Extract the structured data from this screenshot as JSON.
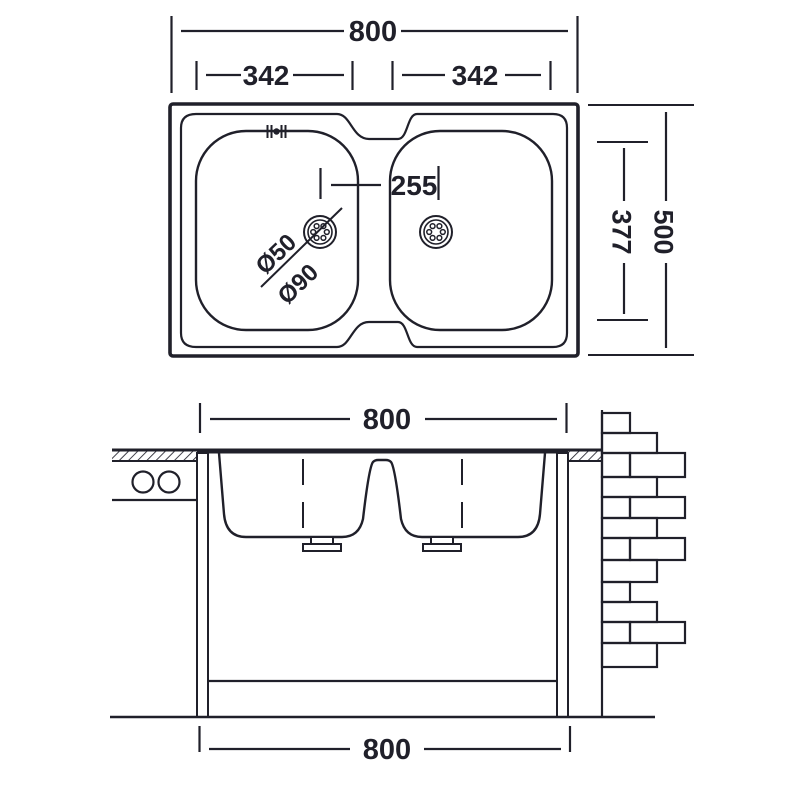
{
  "colors": {
    "line": "#20202a",
    "background": "#ffffff"
  },
  "plan_view": {
    "overall_width_mm": "800",
    "left_bowl_width_mm": "342",
    "right_bowl_width_mm": "342",
    "overall_depth_mm": "500",
    "bowl_depth_mm": "377",
    "drain_offset_mm": "255",
    "drain_diameter": "Ø50",
    "drain_flange_diameter": "Ø90"
  },
  "section_view": {
    "top_width_mm": "800",
    "bottom_width_mm": "800"
  }
}
